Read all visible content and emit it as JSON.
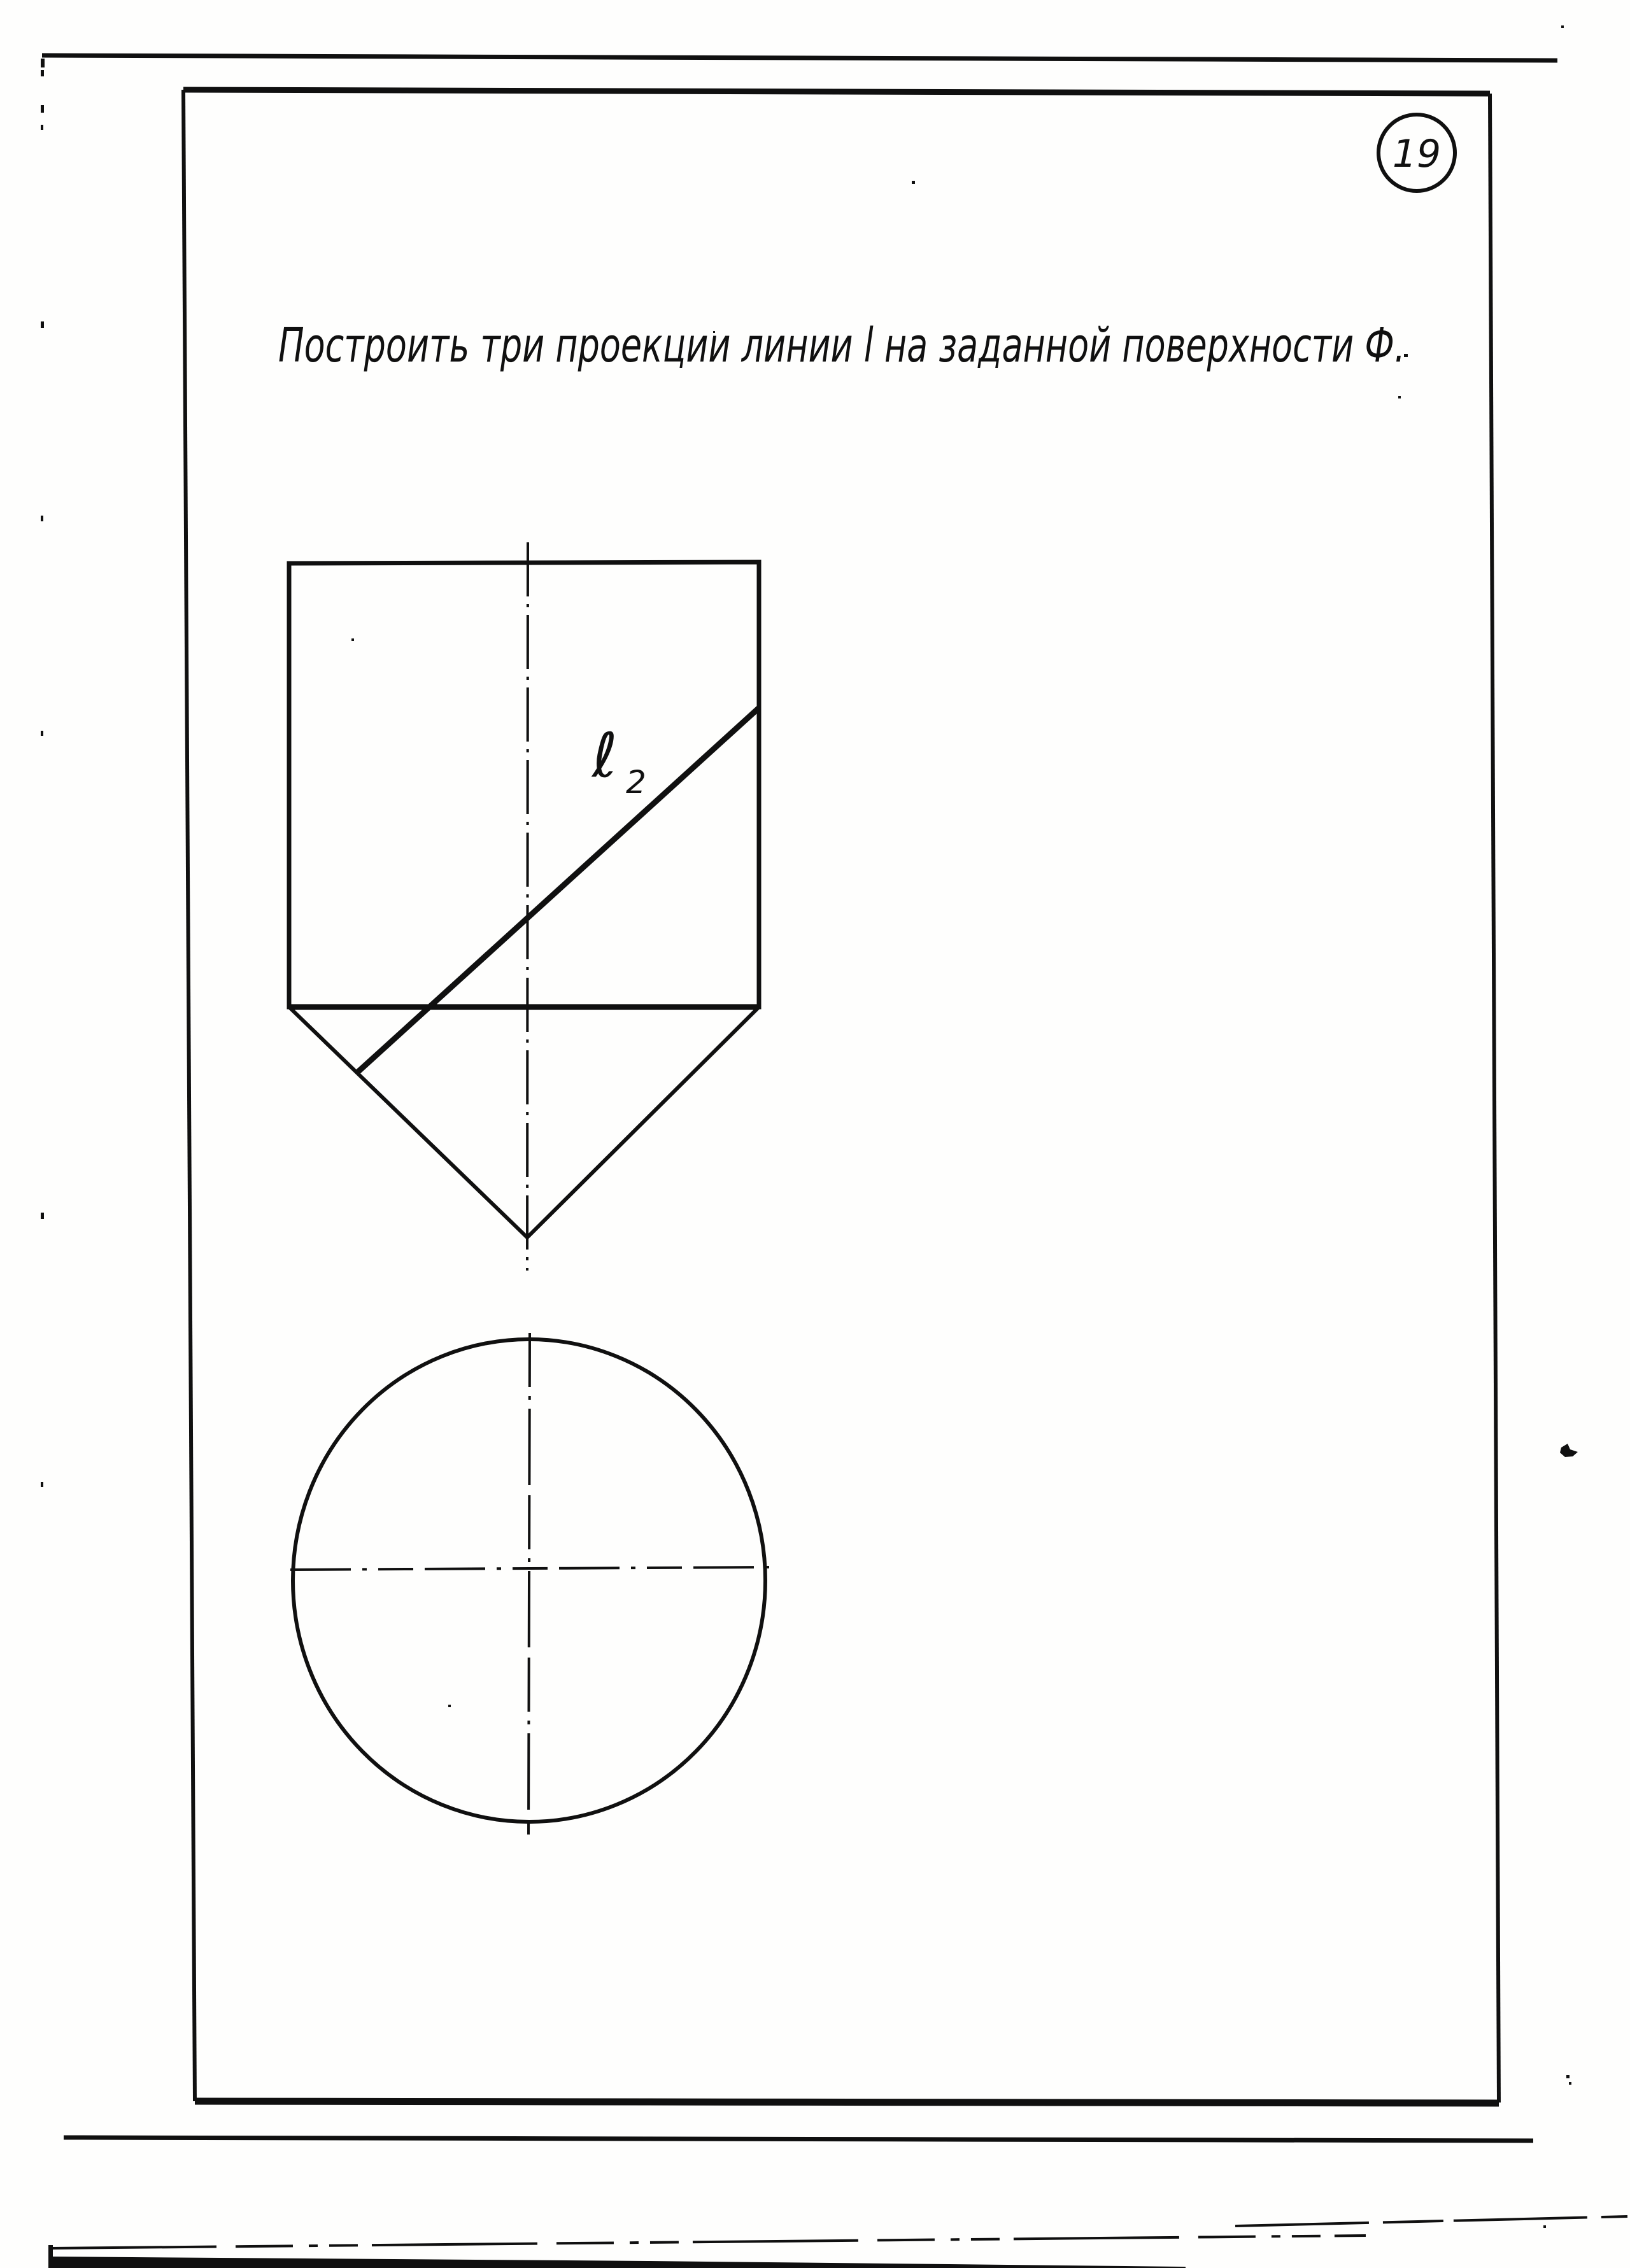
{
  "page": {
    "number": "19",
    "task_text": "Построить три проекции линии l на заданной поверхности Ф.",
    "line_label": {
      "base": "ℓ",
      "sub": "2"
    }
  },
  "colors": {
    "ink": "#101010",
    "paper": "#fefefd"
  }
}
